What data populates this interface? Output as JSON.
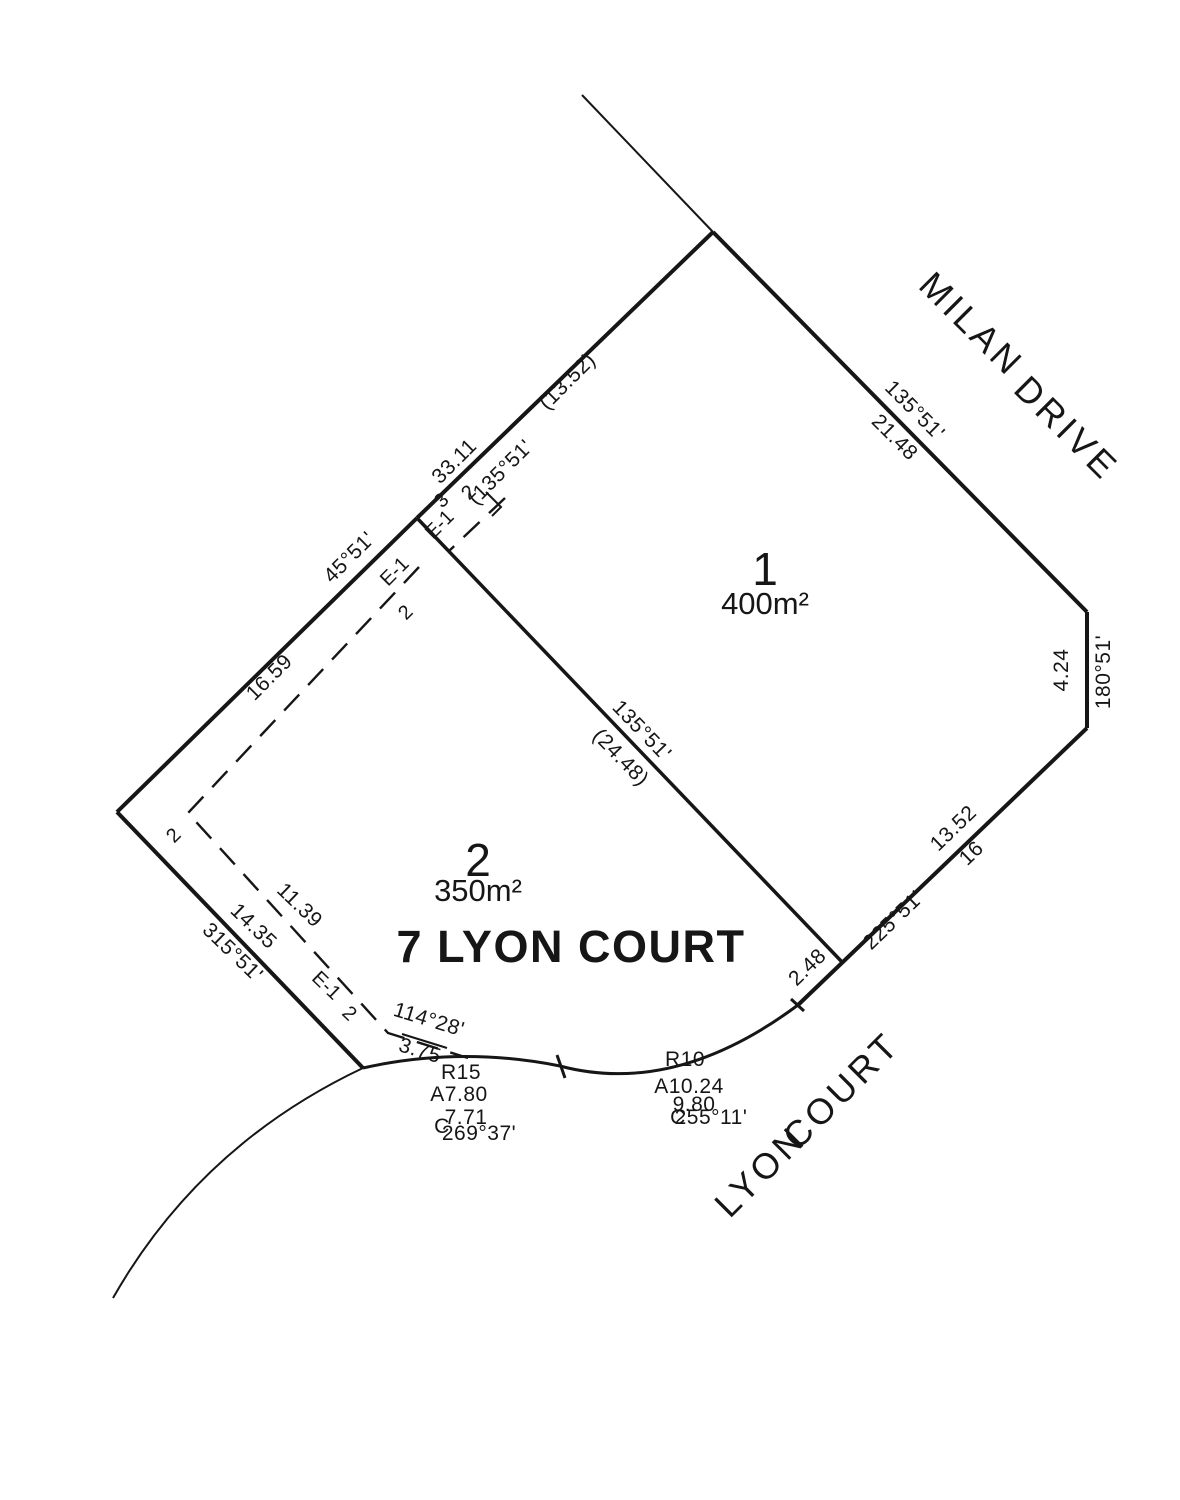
{
  "colors": {
    "line": "#161616",
    "highlight_red": "#d9262c"
  },
  "streets": {
    "milan_word1": "MILAN",
    "milan_word2": "DRIVE",
    "lyon_word1": "LYON",
    "lyon_word2": "COURT"
  },
  "lots": {
    "lot1": {
      "number": "1",
      "area": "400m²"
    },
    "lot2": {
      "number": "2",
      "area": "350m²"
    }
  },
  "address_label": "7 LYON COURT",
  "dims": {
    "ne_ref_dist": "(13.52)",
    "ne_dist": "33.11",
    "ne_bearing": "(135°51'",
    "offset3": "3",
    "offset2_top": "2",
    "easement_a": "E-1",
    "easement_b": "E-1",
    "offset2_nw": "2",
    "nw_bearing": "45°51'",
    "nw_dist": "16.59",
    "milan_bearing": "135°51'",
    "milan_dist": "21.48",
    "east_dist": "4.24",
    "east_bearing": "180°51'",
    "se_dist": "13.52",
    "se_dist2": "16",
    "se_bearing": "225°51'",
    "div_bearing": "135°51'",
    "div_dist": "(24.48)",
    "sw_dist": "14.35",
    "sw_bearing": "315°51'",
    "esw_dist": "11.39",
    "easement_c": "E-1",
    "offset2_corner": "2",
    "offset2_sw": "2",
    "frac_bearing": "114°28'",
    "frac_dist": "3.75",
    "curve1_radius": "R15",
    "curve1_arc": "A7.80",
    "curve1_c": "C",
    "curve1_chord": "7.71",
    "curve1_chord_bearing": "269°37'",
    "curve2_radius": "R10",
    "curve2_arc": "A10.24",
    "curve2_chord": "9.80",
    "curve2_c": "C",
    "curve2_chord_bearing": "255°11'",
    "tangent_dist": "2.48"
  }
}
